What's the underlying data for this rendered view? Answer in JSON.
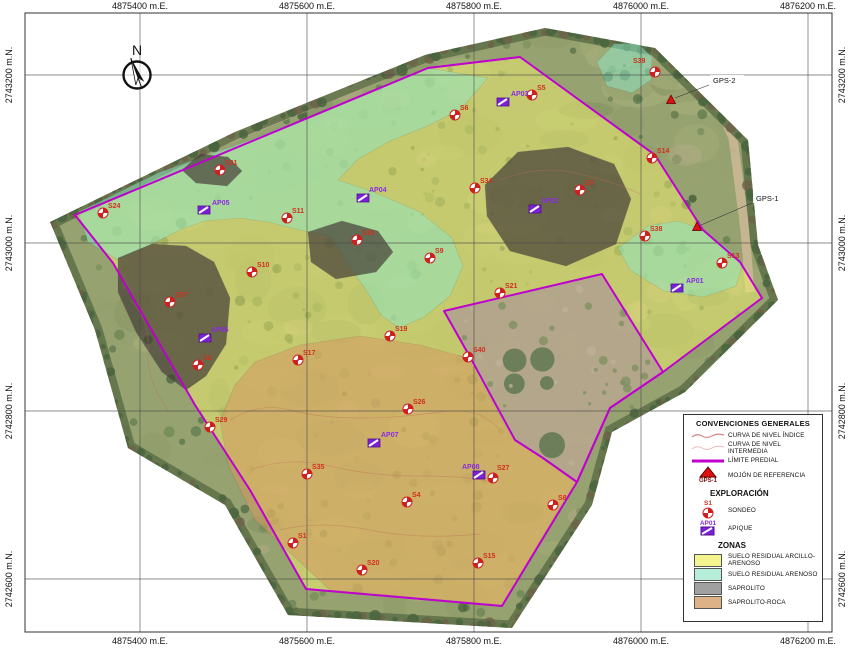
{
  "colors": {
    "boundary": "#bf00cf",
    "sondeo": "#cf2020",
    "sondeo_label": "#d03020",
    "apique": "#7d1fd6",
    "apique_label": "#8a2be2",
    "benchmark": "#e01010",
    "grid": "#4a4a4a",
    "zone_yellow": "#f0ef6f",
    "zone_teal": "#8ce8c8",
    "zone_dark": "#48423a",
    "zone_tan": "#d49a62",
    "legend_yellow": "#f4f48e",
    "legend_teal": "#b6eed9",
    "legend_gray": "#a0a0a0",
    "legend_tan": "#dcb286",
    "contour": "#c06a58"
  },
  "grid": {
    "frame": {
      "x0": 25,
      "y0": 13,
      "x1": 832,
      "y1": 632
    },
    "x_ticks": [
      {
        "label": "4875400 m.E.",
        "x": 140
      },
      {
        "label": "4875600 m.E.",
        "x": 307
      },
      {
        "label": "4875800 m.E.",
        "x": 474
      },
      {
        "label": "4876000 m.E.",
        "x": 641
      },
      {
        "label": "4876200 m.E.",
        "x": 808
      }
    ],
    "y_ticks": [
      {
        "label": "2743200 m.N.",
        "y": 75
      },
      {
        "label": "2743000 m.N.",
        "y": 243
      },
      {
        "label": "2742800 m.N.",
        "y": 411
      },
      {
        "label": "2742600 m.N.",
        "y": 579
      }
    ]
  },
  "compass": {
    "label": "N",
    "x": 137,
    "y": 75
  },
  "map": {
    "photo_extent": [
      [
        50,
        222
      ],
      [
        235,
        132
      ],
      [
        425,
        55
      ],
      [
        545,
        28
      ],
      [
        655,
        48
      ],
      [
        748,
        140
      ],
      [
        758,
        245
      ],
      [
        778,
        300
      ],
      [
        685,
        392
      ],
      [
        612,
        432
      ],
      [
        592,
        505
      ],
      [
        512,
        628
      ],
      [
        288,
        615
      ],
      [
        225,
        505
      ],
      [
        128,
        448
      ],
      [
        95,
        330
      ]
    ],
    "boundary_outer": [
      [
        75,
        215
      ],
      [
        250,
        142
      ],
      [
        428,
        68
      ],
      [
        520,
        57
      ],
      [
        655,
        155
      ],
      [
        703,
        230
      ],
      [
        740,
        262
      ],
      [
        762,
        298
      ],
      [
        663,
        372
      ],
      [
        610,
        408
      ],
      [
        577,
        482
      ],
      [
        502,
        606
      ],
      [
        306,
        589
      ],
      [
        250,
        490
      ],
      [
        195,
        405
      ],
      [
        113,
        263
      ]
    ],
    "boundary_exclusion": [
      [
        444,
        311
      ],
      [
        602,
        274
      ],
      [
        663,
        372
      ],
      [
        610,
        408
      ],
      [
        577,
        482
      ],
      [
        543,
        458
      ],
      [
        515,
        440
      ],
      [
        470,
        357
      ]
    ],
    "zone_polygons": [
      {
        "zone": "SUELO RESIDUAL ARCILLO-ARENOSO",
        "fill": "zone_yellow",
        "opacity": 0.52,
        "points": [
          [
            75,
            215
          ],
          [
            250,
            142
          ],
          [
            428,
            68
          ],
          [
            520,
            57
          ],
          [
            655,
            155
          ],
          [
            703,
            230
          ],
          [
            740,
            262
          ],
          [
            762,
            298
          ],
          [
            663,
            372
          ],
          [
            610,
            408
          ],
          [
            577,
            482
          ],
          [
            502,
            606
          ],
          [
            306,
            589
          ],
          [
            250,
            490
          ],
          [
            195,
            405
          ],
          [
            113,
            263
          ]
        ]
      },
      {
        "zone": "SUELO RESIDUAL ARENOSO",
        "fill": "zone_teal",
        "opacity": 0.5,
        "points": [
          [
            78,
            212
          ],
          [
            160,
            172
          ],
          [
            250,
            140
          ],
          [
            340,
            104
          ],
          [
            428,
            68
          ],
          [
            488,
            78
          ],
          [
            460,
            110
          ],
          [
            425,
            127
          ],
          [
            390,
            141
          ],
          [
            358,
            159
          ],
          [
            338,
            180
          ],
          [
            374,
            192
          ],
          [
            420,
            212
          ],
          [
            452,
            238
          ],
          [
            463,
            266
          ],
          [
            450,
            296
          ],
          [
            424,
            317
          ],
          [
            399,
            328
          ],
          [
            381,
            315
          ],
          [
            366,
            290
          ],
          [
            348,
            264
          ],
          [
            330,
            236
          ],
          [
            300,
            230
          ],
          [
            268,
            222
          ],
          [
            240,
            218
          ],
          [
            205,
            221
          ],
          [
            180,
            230
          ],
          [
            150,
            245
          ],
          [
            118,
            260
          ],
          [
            88,
            242
          ]
        ]
      },
      {
        "zone": "SUELO RESIDUAL ARENOSO",
        "fill": "zone_teal",
        "opacity": 0.5,
        "points": [
          [
            618,
            248
          ],
          [
            648,
            226
          ],
          [
            678,
            221
          ],
          [
            702,
            229
          ],
          [
            730,
            250
          ],
          [
            742,
            266
          ],
          [
            736,
            286
          ],
          [
            704,
            297
          ],
          [
            664,
            291
          ],
          [
            630,
            270
          ]
        ]
      },
      {
        "zone": "SUELO RESIDUAL ARENOSO",
        "fill": "zone_teal",
        "opacity": 0.5,
        "points": [
          [
            597,
            62
          ],
          [
            614,
            44
          ],
          [
            638,
            43
          ],
          [
            652,
            57
          ],
          [
            651,
            80
          ],
          [
            632,
            93
          ],
          [
            607,
            86
          ]
        ]
      },
      {
        "zone": "SAPROLITO",
        "fill": "zone_dark",
        "opacity": 0.72,
        "points": [
          [
            182,
            170
          ],
          [
            200,
            154
          ],
          [
            228,
            157
          ],
          [
            242,
            171
          ],
          [
            227,
            186
          ],
          [
            196,
            183
          ]
        ]
      },
      {
        "zone": "SAPROLITO",
        "fill": "zone_dark",
        "opacity": 0.72,
        "points": [
          [
            118,
            258
          ],
          [
            152,
            244
          ],
          [
            186,
            246
          ],
          [
            214,
            262
          ],
          [
            230,
            298
          ],
          [
            226,
            344
          ],
          [
            206,
            376
          ],
          [
            186,
            390
          ],
          [
            162,
            372
          ],
          [
            136,
            332
          ],
          [
            118,
            292
          ]
        ]
      },
      {
        "zone": "SAPROLITO",
        "fill": "zone_dark",
        "opacity": 0.72,
        "points": [
          [
            308,
            232
          ],
          [
            342,
            221
          ],
          [
            378,
            231
          ],
          [
            393,
            252
          ],
          [
            376,
            272
          ],
          [
            336,
            279
          ],
          [
            311,
            262
          ]
        ]
      },
      {
        "zone": "SAPROLITO",
        "fill": "zone_dark",
        "opacity": 0.72,
        "points": [
          [
            485,
            185
          ],
          [
            518,
            152
          ],
          [
            568,
            147
          ],
          [
            614,
            164
          ],
          [
            631,
            199
          ],
          [
            616,
            244
          ],
          [
            566,
            266
          ],
          [
            510,
            251
          ],
          [
            487,
            216
          ]
        ]
      },
      {
        "zone": "SAPROLITO-ROCA",
        "fill": "zone_tan",
        "opacity": 0.55,
        "points": [
          [
            255,
            362
          ],
          [
            300,
            345
          ],
          [
            360,
            336
          ],
          [
            420,
            345
          ],
          [
            468,
            358
          ],
          [
            512,
            438
          ],
          [
            540,
            457
          ],
          [
            575,
            482
          ],
          [
            502,
            605
          ],
          [
            330,
            590
          ],
          [
            255,
            520
          ],
          [
            228,
            465
          ],
          [
            220,
            420
          ],
          [
            235,
            385
          ]
        ]
      }
    ],
    "sondeos": [
      {
        "id": "S39",
        "x": 655,
        "y": 72,
        "lx": 633,
        "ly": 63
      },
      {
        "id": "S5",
        "x": 532,
        "y": 95
      },
      {
        "id": "S6",
        "x": 455,
        "y": 115
      },
      {
        "id": "S31",
        "x": 220,
        "y": 170
      },
      {
        "id": "S14",
        "x": 652,
        "y": 158
      },
      {
        "id": "S34",
        "x": 475,
        "y": 188
      },
      {
        "id": "S3",
        "x": 580,
        "y": 190
      },
      {
        "id": "S24",
        "x": 103,
        "y": 213
      },
      {
        "id": "S11",
        "x": 287,
        "y": 218
      },
      {
        "id": "S18",
        "x": 357,
        "y": 240
      },
      {
        "id": "S9",
        "x": 430,
        "y": 258
      },
      {
        "id": "S38",
        "x": 645,
        "y": 236
      },
      {
        "id": "S13",
        "x": 722,
        "y": 263
      },
      {
        "id": "S10",
        "x": 252,
        "y": 272
      },
      {
        "id": "S21",
        "x": 500,
        "y": 293
      },
      {
        "id": "S37",
        "x": 170,
        "y": 302
      },
      {
        "id": "S19",
        "x": 390,
        "y": 336
      },
      {
        "id": "S40",
        "x": 468,
        "y": 357
      },
      {
        "id": "S17",
        "x": 298,
        "y": 360
      },
      {
        "id": "S2",
        "x": 198,
        "y": 365
      },
      {
        "id": "S26",
        "x": 408,
        "y": 409
      },
      {
        "id": "S29",
        "x": 210,
        "y": 427
      },
      {
        "id": "S35",
        "x": 307,
        "y": 474
      },
      {
        "id": "S27",
        "x": 493,
        "y": 478,
        "lx": 497,
        "ly": 470
      },
      {
        "id": "S4",
        "x": 407,
        "y": 502
      },
      {
        "id": "S8",
        "x": 553,
        "y": 505
      },
      {
        "id": "S1",
        "x": 293,
        "y": 543
      },
      {
        "id": "S15",
        "x": 478,
        "y": 563
      },
      {
        "id": "S20",
        "x": 362,
        "y": 570
      }
    ],
    "apiques": [
      {
        "id": "AP03",
        "x": 503,
        "y": 102,
        "lx": 511,
        "ly": 96
      },
      {
        "id": "AP04",
        "x": 363,
        "y": 198,
        "lx": 369,
        "ly": 192
      },
      {
        "id": "AP05",
        "x": 204,
        "y": 210,
        "lx": 212,
        "ly": 205
      },
      {
        "id": "AP02",
        "x": 535,
        "y": 209,
        "lx": 541,
        "ly": 203
      },
      {
        "id": "AP06",
        "x": 205,
        "y": 338,
        "lx": 211,
        "ly": 332
      },
      {
        "id": "AP01",
        "x": 677,
        "y": 288,
        "lx": 686,
        "ly": 283
      },
      {
        "id": "AP07",
        "x": 374,
        "y": 443,
        "lx": 381,
        "ly": 437
      },
      {
        "id": "AP08",
        "x": 479,
        "y": 475,
        "lx": 462,
        "ly": 469
      }
    ],
    "benchmarks": [
      {
        "id": "GPS-2",
        "tx": 671,
        "ty": 100,
        "lx": 713,
        "ly": 82
      },
      {
        "id": "GPS-1",
        "tx": 697,
        "ty": 227,
        "lx": 756,
        "ly": 200
      }
    ]
  },
  "legend": {
    "title": "CONVENCIONES GENERALES",
    "conventions": [
      {
        "type": "contour-index",
        "label": "CURVA DE NIVEL ÍNDICE"
      },
      {
        "type": "contour-intermediate",
        "label": "CURVA DE NIVEL INTERMEDIA"
      },
      {
        "type": "boundary",
        "label": "LÍMITE PREDIAL"
      },
      {
        "type": "benchmark",
        "label": "MOJÓN DE REFERENCIA",
        "tag": "GPS-1"
      }
    ],
    "exploration": {
      "title": "EXPLORACIÓN",
      "items": [
        {
          "type": "sondeo",
          "tag": "S1",
          "label": "SONDEO"
        },
        {
          "type": "apique",
          "tag": "AP01",
          "label": "APIQUE"
        }
      ]
    },
    "zones": {
      "title": "ZONAS",
      "items": [
        {
          "label": "SUELO RESIDUAL ARCILLO-ARENOSO",
          "color_key": "legend_yellow"
        },
        {
          "label": "SUELO RESIDUAL ARENOSO",
          "color_key": "legend_teal"
        },
        {
          "label": "SAPROLITO",
          "color_key": "legend_gray"
        },
        {
          "label": "SAPROLITO-ROCA",
          "color_key": "legend_tan"
        }
      ]
    }
  }
}
